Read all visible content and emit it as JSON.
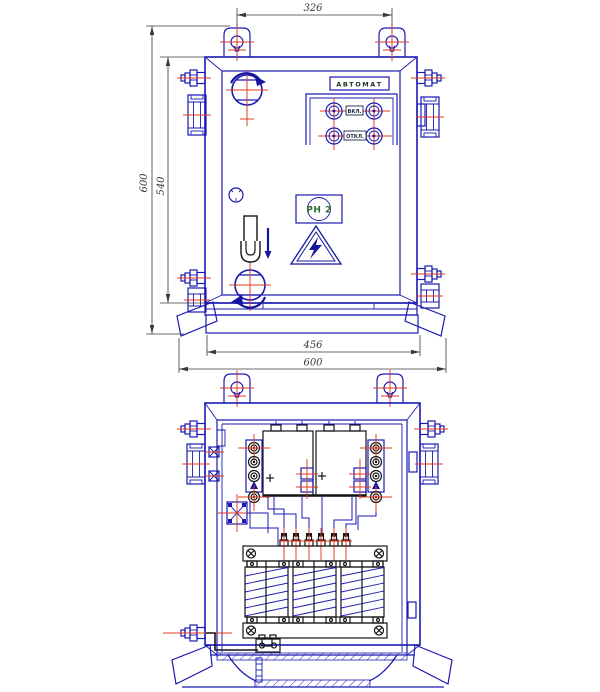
{
  "drawing": {
    "colors": {
      "line_blue": "#1a1ab2",
      "centerline_red": "#e23a1e",
      "detail_black": "#141414",
      "dimension_gray": "#3a3a3a",
      "relay_text_green": "#2e6b2e",
      "background": "#ffffff"
    },
    "front_view": {
      "labels": {
        "automat": "АВТОМАТ",
        "on_button": "ВКЛ.",
        "off_button": "ОТКЛ.",
        "relay_plate": "РН 2"
      },
      "dimensions": {
        "lug_spacing": "326",
        "overall_height": "600",
        "body_height": "540",
        "plinth_width": "456",
        "overall_width": "600"
      }
    }
  }
}
